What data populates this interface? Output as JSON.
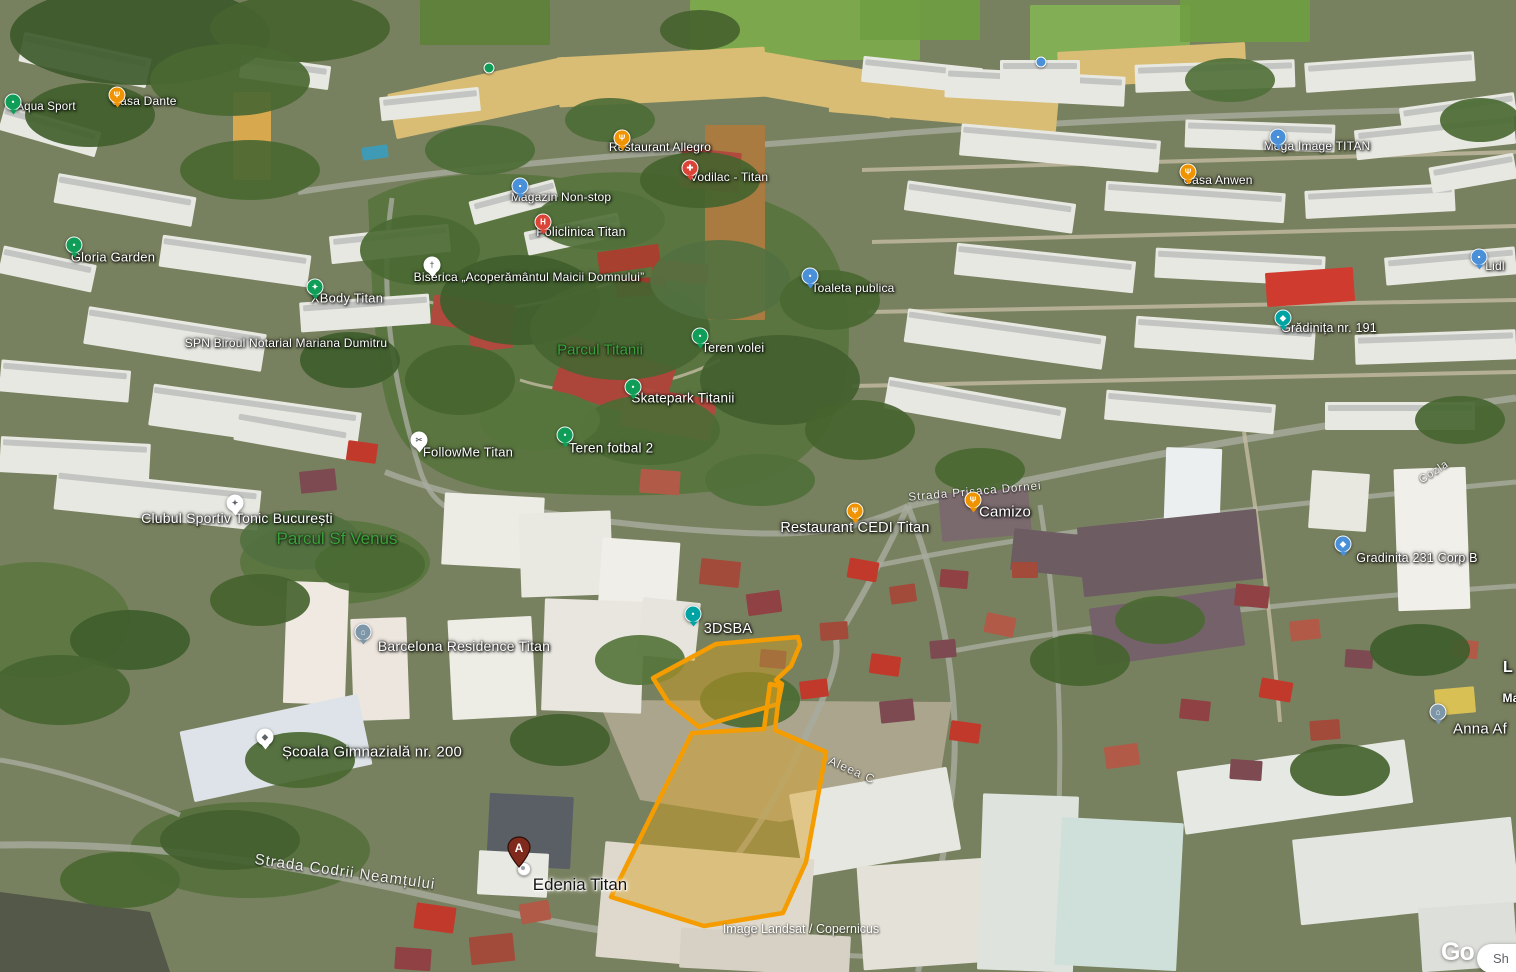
{
  "attribution": "Image Landsat / Copernicus",
  "branding": {
    "google_logo_partial": "Go",
    "overlay_button_partial": "Sh"
  },
  "search_result": {
    "marker_letter": "A",
    "label": "Edenia Titan"
  },
  "highlight": {
    "parcel_outline_color": "#f59d00",
    "parcel_fill": "rgba(214,160,30,0.45)"
  },
  "pin_colors": {
    "green": "#0f9d58",
    "blue": "#4a90d9",
    "orange": "#f09300",
    "red": "#dc4437",
    "slate": "#7d96a8",
    "teal": "#00a3a3",
    "white": "#ffffff"
  },
  "park_label_color": "#3aa23a",
  "parks": [
    {
      "label": "Parcul Titanii",
      "x": 600,
      "y": 350,
      "size": 15
    },
    {
      "label": "Parcul Sf Venus",
      "x": 337,
      "y": 539,
      "size": 17
    }
  ],
  "streets": [
    {
      "label": "Strada Codrii Neamțului",
      "x": 345,
      "y": 872,
      "rot": 8,
      "size": 15
    },
    {
      "label": "Strada Prisaca Dornei",
      "x": 975,
      "y": 492,
      "rot": -5,
      "size": 11.5
    },
    {
      "label": "Aleea C",
      "x": 852,
      "y": 770,
      "rot": 24,
      "size": 12
    },
    {
      "label": "Cozla",
      "x": 1434,
      "y": 472,
      "rot": -33,
      "size": 11
    }
  ],
  "places": [
    {
      "label": "Aqua Sport",
      "lx": 46,
      "ly": 107,
      "px": 13,
      "py": 102,
      "pin": "green",
      "icon": "tree-icon",
      "size": 11.5
    },
    {
      "label": "Casa Dante",
      "lx": 144,
      "ly": 101,
      "px": 117,
      "py": 95,
      "pin": "orange",
      "icon": "restaurant-icon",
      "size": 12
    },
    {
      "label": "Gloria Garden",
      "lx": 113,
      "ly": 257,
      "px": 74,
      "py": 245,
      "pin": "green",
      "icon": "tree-icon",
      "size": 13
    },
    {
      "label": "XBody Titan",
      "lx": 347,
      "ly": 298,
      "px": 315,
      "py": 287,
      "pin": "green",
      "icon": "fitness-icon",
      "size": 13
    },
    {
      "label": "SPN Biroul Notarial Mariana Dumitru",
      "lx": 286,
      "ly": 343,
      "pin": null,
      "icon": null,
      "size": 12
    },
    {
      "label": "Restaurant Allegro",
      "lx": 660,
      "ly": 147,
      "px": 622,
      "py": 138,
      "pin": "orange",
      "icon": "restaurant-icon",
      "size": 12
    },
    {
      "label": "Vodilac - Titan",
      "lx": 729,
      "ly": 177,
      "px": 690,
      "py": 168,
      "pin": "red",
      "icon": "plus-icon",
      "size": 12
    },
    {
      "label": "Magazin Non-stop",
      "lx": 561,
      "ly": 197,
      "px": 520,
      "py": 186,
      "pin": "blue",
      "icon": "shopping-icon",
      "size": 12
    },
    {
      "label": "Policlinica Titan",
      "lx": 581,
      "ly": 232,
      "px": 543,
      "py": 222,
      "pin": "red",
      "icon": "hospital-icon",
      "size": 12.5
    },
    {
      "label": "Biserica „Acoperământul Maicii Domnului”",
      "lx": 529,
      "ly": 277,
      "px": 432,
      "py": 265,
      "pin": "white",
      "icon": "church-cross-icon",
      "size": 12
    },
    {
      "label": "Teren volei",
      "lx": 733,
      "ly": 348,
      "px": 700,
      "py": 336,
      "pin": "green",
      "icon": "sport-icon",
      "size": 12.5
    },
    {
      "label": "Skatepark Titanii",
      "lx": 683,
      "ly": 398,
      "px": 633,
      "py": 387,
      "pin": "green",
      "icon": "sport-icon",
      "size": 13.5
    },
    {
      "label": "Teren fotbal 2",
      "lx": 611,
      "ly": 448,
      "px": 565,
      "py": 435,
      "pin": "green",
      "icon": "sport-icon",
      "size": 13.5
    },
    {
      "label": "FollowMe Titan",
      "lx": 468,
      "ly": 452,
      "px": 419,
      "py": 440,
      "pin": "white",
      "icon": "scissors-icon",
      "size": 13
    },
    {
      "label": "Toaleta publica",
      "lx": 853,
      "ly": 288,
      "px": 810,
      "py": 276,
      "pin": "blue",
      "icon": "toilet-icon",
      "size": 12
    },
    {
      "label": "Mega Image TITAN",
      "lx": 1317,
      "ly": 146,
      "px": 1278,
      "py": 137,
      "pin": "blue",
      "icon": "shopping-icon",
      "size": 12
    },
    {
      "label": "Casa Anwen",
      "lx": 1218,
      "ly": 180,
      "px": 1188,
      "py": 172,
      "pin": "orange",
      "icon": "restaurant-icon",
      "size": 12
    },
    {
      "label": "Grădinița nr. 191",
      "lx": 1329,
      "ly": 328,
      "px": 1283,
      "py": 318,
      "pin": "teal",
      "icon": "school-icon",
      "size": 12.5
    },
    {
      "label": "Lidl",
      "lx": 1495,
      "ly": 266,
      "px": 1479,
      "py": 257,
      "pin": "blue",
      "icon": "shopping-icon",
      "size": 12
    },
    {
      "label": "Restaurant CEDI Titan",
      "lx": 855,
      "ly": 528,
      "px": 855,
      "py": 511,
      "pin": "orange",
      "icon": "restaurant-icon",
      "size": 14.5
    },
    {
      "label": "Camizo",
      "lx": 1005,
      "ly": 512,
      "px": 973,
      "py": 500,
      "pin": "orange",
      "icon": "restaurant-icon",
      "size": 15
    },
    {
      "label": "3DSBA",
      "lx": 728,
      "ly": 629,
      "px": 693,
      "py": 614,
      "pin": "teal",
      "icon": "dot-icon",
      "size": 14.5
    },
    {
      "label": "Barcelona Residence Titan",
      "lx": 464,
      "ly": 646,
      "px": 363,
      "py": 632,
      "pin": "slate",
      "icon": "lodging-icon",
      "size": 14
    },
    {
      "label": "Clubul Sportiv Tonic București",
      "lx": 237,
      "ly": 518,
      "px": 235,
      "py": 503,
      "pin": "white",
      "icon": "fitness-icon",
      "size": 14
    },
    {
      "label": "Școala Gimnazială nr. 200",
      "lx": 372,
      "ly": 752,
      "px": 265,
      "py": 737,
      "pin": "white",
      "icon": "graduation-icon",
      "size": 15
    },
    {
      "label": "Gradinita 231 Corp B",
      "lx": 1417,
      "ly": 558,
      "px": 1343,
      "py": 544,
      "pin": "blue",
      "icon": "school-icon",
      "size": 12.5
    },
    {
      "label": "Anna Af",
      "lx": 1480,
      "ly": 729,
      "px": 1438,
      "py": 712,
      "pin": "slate",
      "icon": "lodging-icon",
      "size": 15
    },
    {
      "label": "L",
      "lx": 1508,
      "ly": 668,
      "pin": null,
      "icon": null,
      "size": 16
    },
    {
      "label": "Ma",
      "lx": 1511,
      "ly": 698,
      "pin": null,
      "icon": null,
      "size": 12
    }
  ],
  "tiny_pins": [
    {
      "x": 489,
      "y": 68,
      "pin": "green"
    },
    {
      "x": 1041,
      "y": 62,
      "pin": "blue"
    }
  ]
}
